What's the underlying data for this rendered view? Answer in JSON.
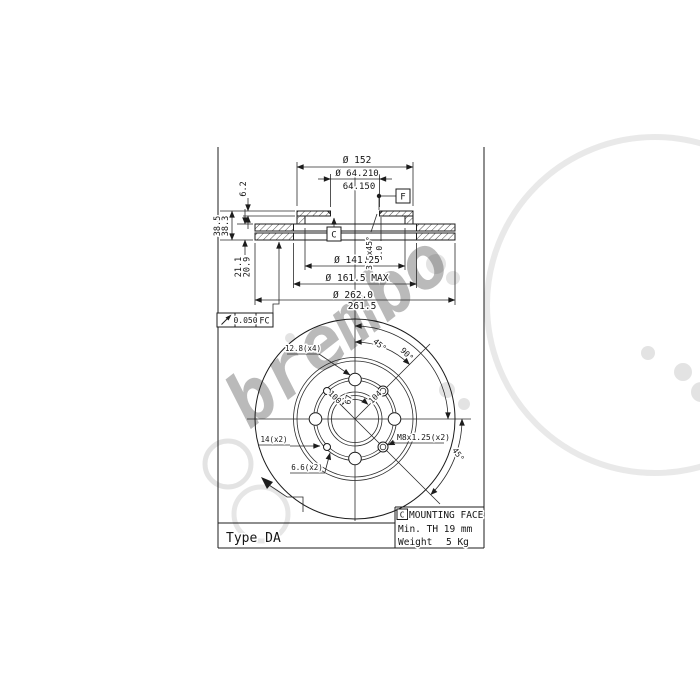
{
  "watermark": {
    "text": "brembo"
  },
  "title_block": {
    "type_label": "Type DA"
  },
  "info_box": {
    "datum": "C",
    "title": "MOUNTING FACE",
    "min_thickness": "Min. TH 19 mm",
    "weight_label": "Weight",
    "weight_value": "5 Kg"
  },
  "tolerance_frame": {
    "value": "0.050",
    "datum": "FC"
  },
  "section": {
    "dia_hat": "Ø 152",
    "bore_max": "Ø 64.210",
    "bore_min": "64.150",
    "flange_thickness": "6.2",
    "height_max": "38.5",
    "height_min": "38.3",
    "thickness_max": "21.1",
    "thickness_min": "20.9",
    "chamfer": "3.5x45°",
    "chamfer_depth": "3.0",
    "datum_c": "C",
    "datum_f": "F",
    "dia_inner": "Ø 141.25",
    "dia_band_inner": "Ø 161.5 MAX",
    "dia_outer_max": "Ø 262.0",
    "dia_outer_min": "261.5"
  },
  "plan": {
    "stud_holes": "12.8(x4)",
    "pcd_left": "100",
    "pcd_right": "104",
    "hub_dim": "67",
    "angle_ne": "45°",
    "angle_e": "90°",
    "angle_se": "45°",
    "counterbore": "14(x2)",
    "screw_holes": "6.6(x2)",
    "thread_holes": "M8x1.25(x2)"
  }
}
